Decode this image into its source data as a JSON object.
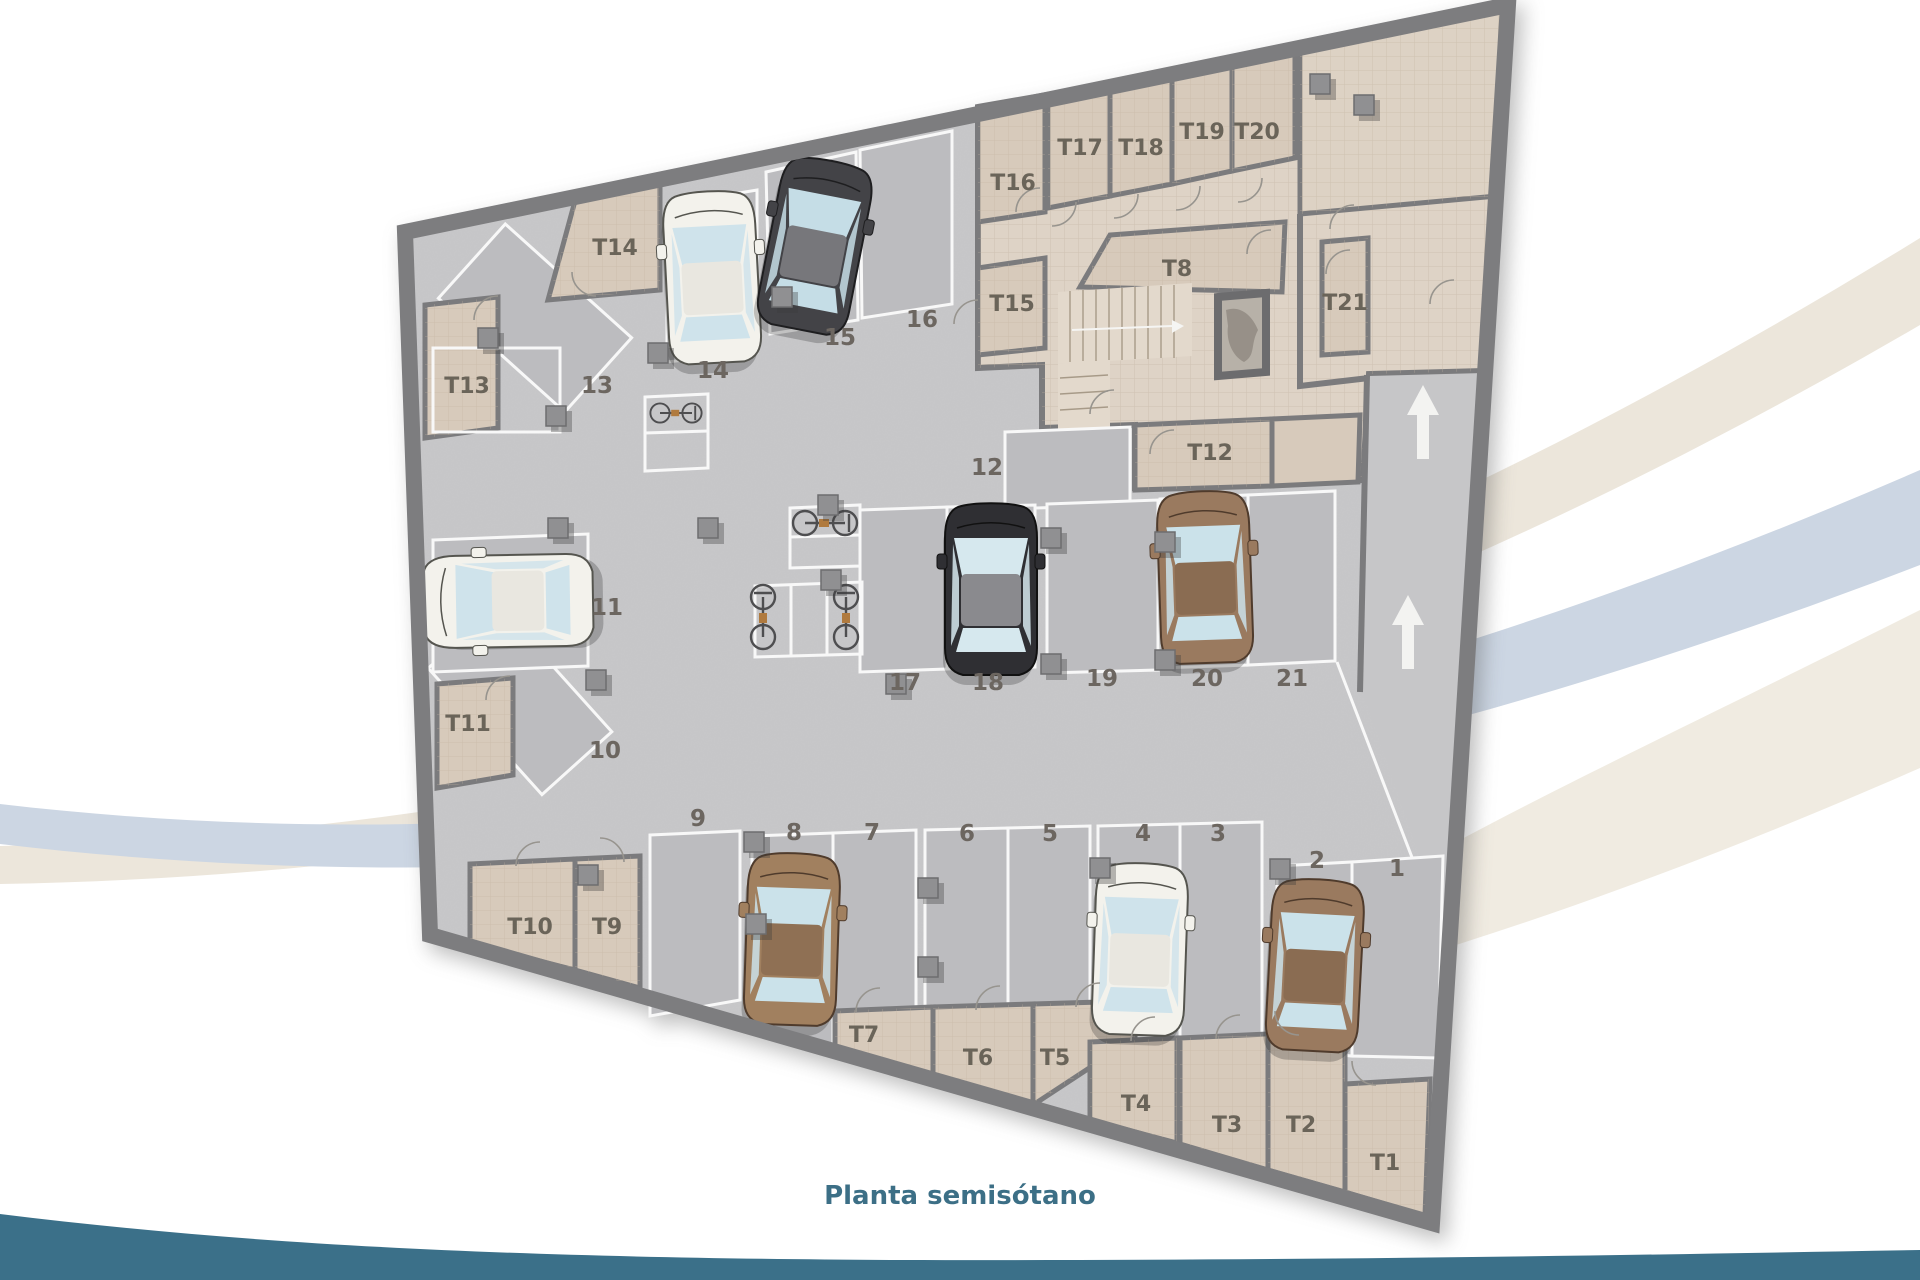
{
  "title": {
    "text": "Planta semisótano"
  },
  "floor_plan": {
    "type": "parking-garage-floor-plan",
    "parking_spots": [
      {
        "label": "1"
      },
      {
        "label": "2"
      },
      {
        "label": "3"
      },
      {
        "label": "4"
      },
      {
        "label": "5"
      },
      {
        "label": "6"
      },
      {
        "label": "7"
      },
      {
        "label": "8"
      },
      {
        "label": "9"
      },
      {
        "label": "10"
      },
      {
        "label": "11"
      },
      {
        "label": "12"
      },
      {
        "label": "13"
      },
      {
        "label": "14"
      },
      {
        "label": "15"
      },
      {
        "label": "16"
      },
      {
        "label": "17"
      },
      {
        "label": "18"
      },
      {
        "label": "19"
      },
      {
        "label": "20"
      },
      {
        "label": "21"
      }
    ],
    "storage_rooms": [
      {
        "label": "T1"
      },
      {
        "label": "T2"
      },
      {
        "label": "T3"
      },
      {
        "label": "T4"
      },
      {
        "label": "T5"
      },
      {
        "label": "T6"
      },
      {
        "label": "T7"
      },
      {
        "label": "T8"
      },
      {
        "label": "T9"
      },
      {
        "label": "T10"
      },
      {
        "label": "T11"
      },
      {
        "label": "T12"
      },
      {
        "label": "T13"
      },
      {
        "label": "T14"
      },
      {
        "label": "T15"
      },
      {
        "label": "T16"
      },
      {
        "label": "T17"
      },
      {
        "label": "T18"
      },
      {
        "label": "T19"
      },
      {
        "label": "T20"
      },
      {
        "label": "T21"
      }
    ],
    "cars": [
      {
        "spot": "2",
        "color": "brown"
      },
      {
        "spot": "4",
        "color": "white"
      },
      {
        "spot": "8",
        "color": "brown"
      },
      {
        "spot": "11",
        "color": "white"
      },
      {
        "spot": "14",
        "color": "white"
      },
      {
        "spot": "15",
        "color": "dark-grey"
      },
      {
        "spot": "18",
        "color": "black"
      },
      {
        "spot": "20",
        "color": "brown"
      }
    ],
    "bicycles": {
      "count": 4
    },
    "ramp": {
      "arrows": 2,
      "direction": "up"
    },
    "features": [
      "stairs",
      "elevator"
    ]
  },
  "colors": {
    "footer_band": "#3b7089",
    "title_text": "#3c6f86",
    "floor": "#c8c8ca",
    "parking_bay": "#bcbcbf",
    "storage_room": "#d7cabb",
    "corridor": "#ded3c6",
    "walls": "#7b7b7d",
    "swoosh_cream": "#ece6db",
    "swoosh_blue": "#ccd6e3"
  }
}
